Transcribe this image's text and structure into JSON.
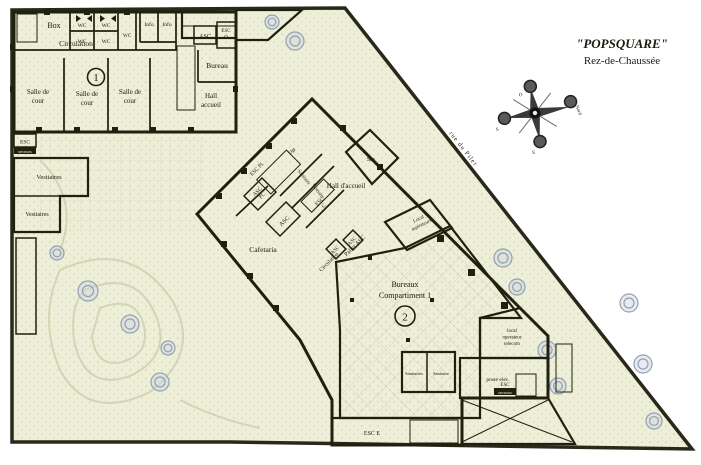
{
  "title": {
    "line1": "\"POPSQUARE\"",
    "line2": "Rez-de-Chaussée"
  },
  "street": "rue du Piler",
  "compass": {
    "n": "Nord",
    "o": "O",
    "s": "S",
    "e": "E"
  },
  "blue": {
    "box": "Box",
    "circulation": "Circulation",
    "wc": [
      "WC",
      "WC",
      "WC",
      "WC",
      "WC"
    ],
    "info": [
      "Info",
      "Info"
    ],
    "asc": "ASC",
    "esc_o": {
      "l1": "ESC",
      "l2": "O"
    },
    "bureau": "Bureau",
    "salle": {
      "l1": "Salle de",
      "l2": "cour"
    },
    "hall": {
      "l1": "Hall",
      "l2": "accueil"
    },
    "num": "1"
  },
  "left": {
    "esc": "ESC",
    "esc_band": "secours",
    "vestiaires": [
      "Vestiaires",
      "Vestiaires"
    ]
  },
  "cream": {
    "esc_pl": "ESC Pl.",
    "dgt": "Dgt",
    "sanitaire": "Sanitaire",
    "vestiaire": "Vestiaire",
    "asc_pl": {
      "l1": "ASC",
      "l2": "Pl."
    },
    "asc_diag": "ASC",
    "esc_c": {
      "l1": "ESC",
      "l2": "C"
    },
    "palier": "Palier ASC",
    "asc_pair": [
      "ASC",
      "ASC"
    ],
    "circulation": "Circulation",
    "hall": "Hall d'accueil",
    "sas": "Sas",
    "cafetaria": "Cafetaria",
    "aspirateurs": {
      "l1": "Local",
      "l2": "aspirateurs"
    }
  },
  "pink": {
    "bureaux": {
      "l1": "Bureaux",
      "l2": "Compartiment 1"
    },
    "num": "2",
    "sanitaires": [
      "Sanitaires",
      "Sanitaire"
    ]
  },
  "right": {
    "telecom": {
      "l1": "local",
      "l2": "operateur",
      "l3": "telecom"
    },
    "poste": "poste elec.",
    "esc": "ESC",
    "esc_band": "secours"
  },
  "bottom": {
    "esc_e": "ESC E"
  },
  "colors": {
    "blue": "#8BDBE8",
    "cream": "#F8F5DC",
    "pink": "#F2A2B6",
    "yellow": "#EFE394",
    "wall": "#20200f",
    "garden": "#EDEFD8",
    "tree": "#93A0B4"
  }
}
